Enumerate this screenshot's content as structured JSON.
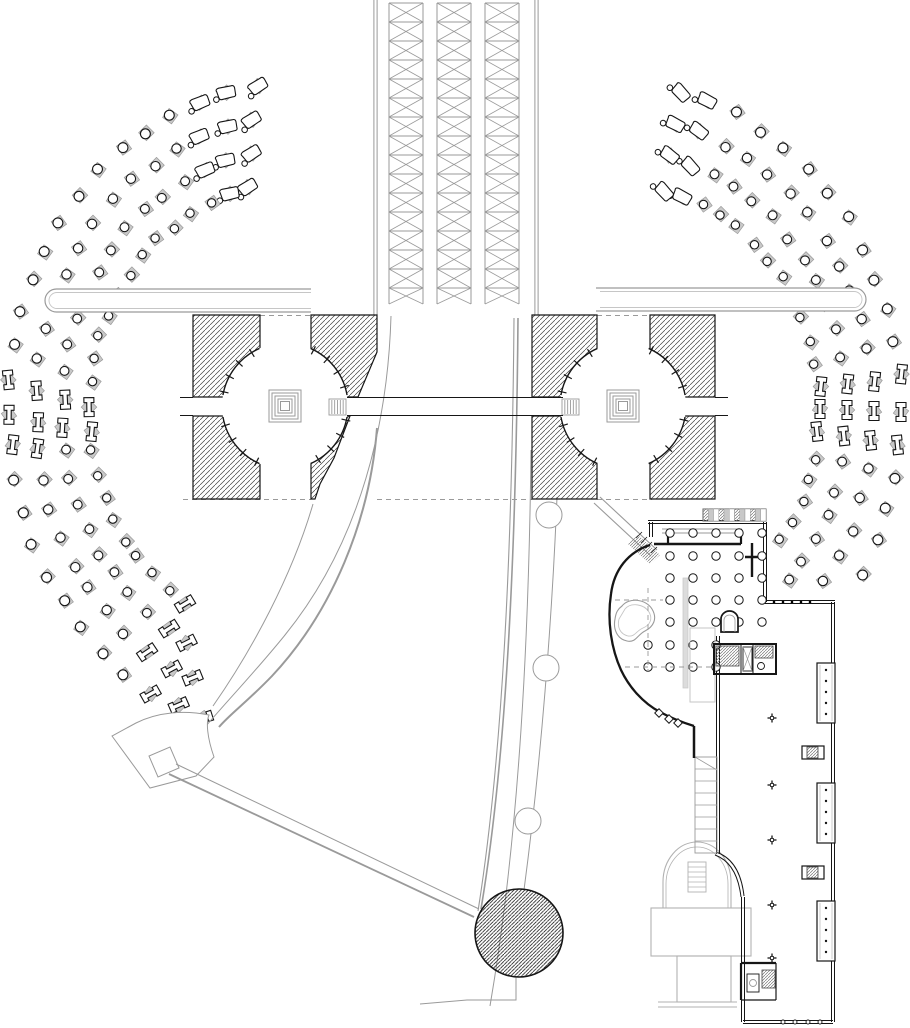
{
  "meta": {
    "title": "architectural-site-plan",
    "canvas_w": 910,
    "canvas_h": 1028,
    "background": "#ffffff"
  },
  "palette": {
    "k": "#161616",
    "g": "#9a9a9a",
    "lg": "#c6c6c6",
    "mg": "#b2b2b2",
    "w": "#ffffff",
    "hatch_line": "#3c3c3c",
    "hatch_dense": "#1a1a1a",
    "hatch_gray": "#777777",
    "marker_fill": "#c9c9c9",
    "marker_edge": "#9a9a9a"
  },
  "truss": {
    "rails": [
      375.5,
      536.5
    ],
    "rail_off": 1.6,
    "y0": 0,
    "y1": 315,
    "columns": [
      [
        389,
        423
      ],
      [
        437,
        471
      ],
      [
        485,
        519
      ]
    ],
    "col_y0": 3,
    "col_y1": 304,
    "panel_h": 19
  },
  "bars": [
    {
      "x0": 45,
      "x1": 311,
      "y": 289,
      "h": 23,
      "cap": "left"
    },
    {
      "x0": 596,
      "x1": 866,
      "y": 288,
      "h": 23,
      "cap": "right"
    }
  ],
  "pavilions": [
    {
      "name": "west",
      "blocks": [
        [
          [
            193,
            315
          ],
          [
            260,
            315
          ],
          [
            260,
            397
          ],
          [
            193,
            397
          ]
        ],
        [
          [
            193,
            416
          ],
          [
            260,
            416
          ],
          [
            260,
            499
          ],
          [
            193,
            499
          ]
        ],
        [
          [
            311,
            315
          ],
          [
            377,
            315
          ],
          [
            377,
            352
          ],
          [
            358,
            397
          ],
          [
            311,
            397
          ]
        ],
        [
          [
            311,
            416
          ],
          [
            350,
            416
          ],
          [
            334,
            458
          ],
          [
            320,
            484
          ],
          [
            315,
            499
          ],
          [
            311,
            499
          ]
        ]
      ],
      "circle": {
        "cx": 285,
        "cy": 406,
        "r": 63
      },
      "squares": [
        32,
        26,
        20,
        14,
        9
      ],
      "arc_segments": [
        [
          10,
          66
        ],
        [
          114,
          170
        ],
        [
          190,
          246
        ],
        [
          294,
          350
        ]
      ],
      "stair_box": {
        "x": 329,
        "y": 399,
        "w": 17,
        "h": 16,
        "n": 6
      }
    },
    {
      "name": "east",
      "blocks": [
        [
          [
            532,
            315
          ],
          [
            597,
            315
          ],
          [
            597,
            397
          ],
          [
            532,
            397
          ]
        ],
        [
          [
            532,
            416
          ],
          [
            597,
            416
          ],
          [
            597,
            499
          ],
          [
            532,
            499
          ]
        ],
        [
          [
            650,
            315
          ],
          [
            715,
            315
          ],
          [
            715,
            397
          ],
          [
            650,
            397
          ]
        ],
        [
          [
            650,
            416
          ],
          [
            715,
            416
          ],
          [
            715,
            499
          ],
          [
            650,
            499
          ]
        ]
      ],
      "circle": {
        "cx": 623,
        "cy": 406,
        "r": 63
      },
      "squares": [
        32,
        26,
        20,
        14,
        9
      ],
      "arc_segments": [
        [
          10,
          66
        ],
        [
          114,
          170
        ],
        [
          190,
          246
        ],
        [
          294,
          350
        ]
      ],
      "stair_box": {
        "x": 562,
        "y": 399,
        "w": 17,
        "h": 16,
        "n": 6
      }
    }
  ],
  "bands": [
    {
      "name": "west",
      "cx": 288,
      "cy": 410,
      "rx0": 198,
      "drx": 27,
      "ry0": 225,
      "dry": 33,
      "step": 6,
      "t0": [
        101,
        99.5,
        98,
        96.5
      ],
      "t1": [
        244,
        248,
        252,
        256
      ],
      "lounge": [
        90,
        112
      ],
      "ibeam": [
        174,
        189
      ],
      "tilt": [
        236,
        270
      ],
      "rot_base": 180,
      "lounge_rot": -30,
      "clips": []
    },
    {
      "name": "east",
      "cx": 622,
      "cy": 410,
      "rx0": 198,
      "drx": 27,
      "ry0": 225,
      "dry": 33,
      "step": 6,
      "t0": [
        -36,
        -42,
        -48,
        -54
      ],
      "t1": [
        78,
        79.5,
        81,
        82.5
      ],
      "lounge": [
        68,
        90
      ],
      "ibeam": [
        -8,
        8
      ],
      "tilt": [
        999,
        999
      ],
      "rot_base": 0,
      "lounge_rot": 30,
      "clips": [
        [
          648,
          508,
          120,
          97
        ],
        [
          768,
          598,
          142,
          430
        ]
      ]
    }
  ],
  "corridor": {
    "y_top": 397.5,
    "y_bot": 415.5,
    "segments": [
      [
        180,
        193
      ],
      [
        347,
        563
      ],
      [
        715,
        728
      ]
    ]
  },
  "promenade": [
    {
      "t": "path",
      "d": "M391,316 C388,420 362,540 285,635 C255,672 228,700 206,726",
      "c": "g",
      "w": 1
    },
    {
      "t": "path",
      "d": "M377,428 C370,520 332,612 272,676 C247,702 230,714 219,727",
      "c": "g",
      "w": 2
    },
    {
      "t": "path",
      "d": "M313,504 C292,576 252,650 213,706",
      "c": "g",
      "w": 1
    },
    {
      "t": "path",
      "d": "M514,318 C512,560 502,760 478,911",
      "c": "g",
      "w": 1.1
    },
    {
      "t": "path",
      "d": "M518,318 C516,560 506,760 481,909",
      "c": "g",
      "w": 1.6
    },
    {
      "t": "path",
      "d": "M531,450 C529,630 520,830 490,1006",
      "c": "g",
      "w": 1
    },
    {
      "t": "path",
      "d": "M557,497 C552,620 541,762 524,890",
      "c": "g",
      "w": 1
    },
    {
      "t": "path",
      "d": "M420,1004 L467,1000 L516,1000 L516,977",
      "c": "g",
      "w": 1
    },
    {
      "t": "dash",
      "x1": 183,
      "y1": 499.5,
      "x2": 311,
      "y2": 499.5
    },
    {
      "t": "dash",
      "x1": 377,
      "y1": 499.5,
      "x2": 532,
      "y2": 499.5
    },
    {
      "t": "dash",
      "x1": 597,
      "y1": 499.5,
      "x2": 652,
      "y2": 499.5
    },
    {
      "t": "dash",
      "x1": 260,
      "y1": 315.5,
      "x2": 311,
      "y2": 315.5
    },
    {
      "t": "dash",
      "x1": 597,
      "y1": 315.5,
      "x2": 650,
      "y2": 315.5
    }
  ],
  "wedge": [
    {
      "t": "path",
      "d": "M112,736 L150,788 L196,776 L214,757 C207,737 206,722 209,715 C184,710 158,712 136,723 Z",
      "c": "g",
      "w": 1,
      "f": "w"
    },
    {
      "t": "poly",
      "pts": [
        [
          179,
          768
        ],
        [
          170,
          747
        ],
        [
          149,
          756
        ],
        [
          158,
          777
        ]
      ],
      "c": "g",
      "w": 1,
      "f": "w"
    }
  ],
  "ramp_sw": [
    {
      "t": "line",
      "x1": 176,
      "y1": 764,
      "x2": 479,
      "y2": 909,
      "c": "g",
      "w": 1
    },
    {
      "t": "line",
      "x1": 169,
      "y1": 774,
      "x2": 474,
      "y2": 917,
      "c": "g",
      "w": 1.8
    }
  ],
  "ramp_ne": [
    {
      "t": "line",
      "x1": 594,
      "y1": 503,
      "x2": 651,
      "y2": 556,
      "c": "g",
      "w": 1.1
    },
    {
      "t": "line",
      "x1": 600,
      "y1": 497,
      "x2": 657,
      "y2": 550,
      "c": "g",
      "w": 1.1
    },
    {
      "t": "poly",
      "pts": [
        [
          638,
          535
        ],
        [
          660,
          555
        ],
        [
          650,
          564
        ],
        [
          628,
          544
        ]
      ],
      "f": "hg"
    },
    {
      "t": "line",
      "x1": 636,
      "y1": 538,
      "x2": 642,
      "y2": 532,
      "c": "k",
      "w": 0.8
    },
    {
      "t": "line",
      "x1": 641,
      "y1": 543,
      "x2": 647,
      "y2": 537,
      "c": "k",
      "w": 0.8
    },
    {
      "t": "line",
      "x1": 646,
      "y1": 548,
      "x2": 652,
      "y2": 542,
      "c": "k",
      "w": 0.8
    },
    {
      "t": "line",
      "x1": 651,
      "y1": 553,
      "x2": 657,
      "y2": 547,
      "c": "k",
      "w": 0.8
    }
  ],
  "path_circles": [
    [
      549,
      515,
      13
    ],
    [
      546,
      668,
      13
    ],
    [
      528,
      821,
      13
    ]
  ],
  "plaza_circle": {
    "cx": 519,
    "cy": 933,
    "r": 44
  },
  "chapel": [
    {
      "t": "path",
      "d": "M663,908 L663,882 A34 40 0 0 1 731,882 L731,908",
      "c": "mg",
      "w": 1.1
    },
    {
      "t": "path",
      "d": "M666,908 L666,884 A31 37 0 0 1 728,884 L728,908",
      "c": "mg",
      "w": 0.8
    },
    {
      "t": "rect",
      "x": 651,
      "y": 908,
      "w": 100,
      "h": 48,
      "c": "mg",
      "w2": 1.1
    },
    {
      "t": "rect",
      "x": 677,
      "y": 956,
      "w": 54,
      "h": 46,
      "c": "mg",
      "w2": 1.1
    },
    {
      "t": "line",
      "x1": 658,
      "y1": 1002,
      "x2": 737,
      "y2": 1002,
      "c": "mg",
      "w": 1
    },
    {
      "t": "line",
      "x1": 658,
      "y1": 1007,
      "x2": 737,
      "y2": 1007,
      "c": "mg",
      "w": 1
    },
    {
      "t": "stairs",
      "x": 688,
      "y": 862,
      "w": 18,
      "h": 30,
      "n": 6,
      "c": "mg"
    }
  ],
  "building": [
    {
      "t": "dline",
      "x1": 648,
      "y1": 522,
      "x2": 766,
      "y2": 522
    },
    {
      "t": "dline",
      "x1": 651,
      "y1": 522,
      "x2": 651,
      "y2": 537
    },
    {
      "t": "dline",
      "x1": 765,
      "y1": 522,
      "x2": 765,
      "y2": 602
    },
    {
      "t": "dline",
      "x1": 765,
      "y1": 602,
      "x2": 835,
      "y2": 602
    },
    {
      "t": "dots",
      "pts": [
        [
          774,
          602
        ],
        [
          783,
          602
        ],
        [
          792,
          602
        ],
        [
          801,
          602
        ],
        [
          810,
          602
        ]
      ],
      "r": 1.3,
      "f": "k"
    },
    {
      "t": "dline",
      "x1": 833,
      "y1": 602,
      "x2": 833,
      "y2": 1022
    },
    {
      "t": "dline",
      "x1": 833,
      "y1": 1022,
      "x2": 743,
      "y2": 1022
    },
    {
      "t": "dots",
      "pts": [
        [
          783,
          1022
        ],
        [
          795,
          1022
        ],
        [
          808,
          1022
        ],
        [
          820,
          1022
        ]
      ],
      "r": 2,
      "f": "w",
      "s": "k"
    },
    {
      "t": "dline",
      "x1": 743,
      "y1": 1022,
      "x2": 743,
      "y2": 897
    },
    {
      "t": "path",
      "d": "M744,896 Q740,860 716,852",
      "c": "k",
      "w": 1
    },
    {
      "t": "path",
      "d": "M741,897 Q737,863 715,855",
      "c": "k",
      "w": 1
    },
    {
      "t": "dline",
      "x1": 718,
      "y1": 636,
      "x2": 718,
      "y2": 854
    },
    {
      "t": "stairs",
      "x": 695,
      "y": 757,
      "w": 22,
      "h": 96,
      "n": 8,
      "c": "g"
    },
    {
      "t": "line",
      "x1": 695,
      "y1": 757,
      "x2": 717,
      "y2": 770,
      "c": "g",
      "w": 0.8
    },
    {
      "t": "line",
      "x1": 694,
      "y1": 726,
      "x2": 694,
      "y2": 758,
      "c": "k",
      "w": 2.5
    },
    {
      "t": "path",
      "d": "M650,545 C628,552 614,570 611,594 C607,620 611,648 621,670 C629,687 643,703 660,712 C671,718 681,722 694,726",
      "c": "k",
      "w": 2.3
    },
    {
      "t": "sq45",
      "x": 659,
      "y": 713,
      "s": 6
    },
    {
      "t": "sq45",
      "x": 669,
      "y": 719,
      "s": 6
    },
    {
      "t": "sq45",
      "x": 678,
      "y": 723,
      "s": 6
    },
    {
      "t": "line",
      "x1": 654,
      "y1": 544,
      "x2": 741,
      "y2": 544,
      "c": "k",
      "w": 2.6
    },
    {
      "t": "line",
      "x1": 668,
      "y1": 531,
      "x2": 668,
      "y2": 544,
      "c": "k",
      "w": 2.2
    },
    {
      "t": "line",
      "x1": 741,
      "y1": 531,
      "x2": 741,
      "y2": 544,
      "c": "k",
      "w": 2.2
    },
    {
      "t": "line",
      "x1": 662,
      "y1": 529,
      "x2": 742,
      "y2": 529,
      "c": "g",
      "w": 0.9
    },
    {
      "t": "line",
      "x1": 662,
      "y1": 533,
      "x2": 742,
      "y2": 533,
      "c": "g",
      "w": 0.9
    },
    {
      "t": "line",
      "x1": 752,
      "y1": 543,
      "x2": 752,
      "y2": 577,
      "c": "k",
      "w": 2.4
    },
    {
      "t": "line",
      "x1": 745,
      "y1": 557,
      "x2": 765,
      "y2": 557,
      "c": "k",
      "w": 2.4
    },
    {
      "t": "cells",
      "x": 703,
      "y": 509,
      "w": 63,
      "h": 12,
      "n": 12
    },
    {
      "t": "grid",
      "cols": [
        670,
        693,
        716,
        739,
        762
      ],
      "rows": [
        533,
        556,
        578,
        600,
        622
      ],
      "r": 4.2
    },
    {
      "t": "grid",
      "cols": [
        648,
        670,
        693,
        716
      ],
      "rows": [
        645,
        667
      ],
      "r": 4.2
    },
    {
      "t": "path",
      "d": "M622,606 C629,597 646,599 652,609 C658,619 653,627 645,631 C637,635 636,643 627,641 C617,639 613,629 615,619 C616,612 618,609 622,606 Z",
      "c": "g",
      "w": 1.1
    },
    {
      "t": "path",
      "d": "M625,609 C631,602 644,604 649,612 C653,619 650,625 643,628 C636,631 635,637 628,636 C620,634 617,627 619,619 Z",
      "c": "lg",
      "w": 0.9
    },
    {
      "t": "path",
      "d": "M721,632 L721,619 A8.5 8 0 0 1 738,619 L738,632 Z",
      "c": "k",
      "w": 1.7,
      "f": "w"
    },
    {
      "t": "path",
      "d": "M724,632 L724,620 A5.5 5 0 0 1 735,620 L735,632",
      "c": "g",
      "w": 0.8
    },
    {
      "t": "rect",
      "x": 690,
      "y": 628,
      "w": 25,
      "h": 74,
      "c": "lg",
      "w2": 1
    },
    {
      "t": "rect",
      "x": 683,
      "y": 578,
      "w": 5,
      "h": 110,
      "c": "lg",
      "w2": 0.7,
      "f": "#dcdcdc"
    },
    {
      "t": "dash",
      "x1": 648,
      "y1": 588,
      "x2": 648,
      "y2": 670
    },
    {
      "t": "dash",
      "x1": 625,
      "y1": 667,
      "x2": 712,
      "y2": 667
    },
    {
      "t": "dash",
      "x1": 615,
      "y1": 600,
      "x2": 663,
      "y2": 600
    },
    {
      "t": "rect",
      "x": 714,
      "y": 644,
      "w": 62,
      "h": 30,
      "c": "k",
      "w2": 2
    },
    {
      "t": "line",
      "x1": 741,
      "y1": 645,
      "x2": 741,
      "y2": 673,
      "c": "k",
      "w": 1
    },
    {
      "t": "line",
      "x1": 753,
      "y1": 645,
      "x2": 753,
      "y2": 673,
      "c": "k",
      "w": 1
    },
    {
      "t": "hatchrect",
      "x": 716,
      "y": 646,
      "w": 23,
      "h": 20
    },
    {
      "t": "rect",
      "x": 743,
      "y": 647,
      "w": 9,
      "h": 24,
      "c": "k",
      "w2": 0.9
    },
    {
      "t": "line",
      "x1": 743,
      "y1": 647,
      "x2": 752,
      "y2": 671,
      "c": "g",
      "w": 0.7
    },
    {
      "t": "line",
      "x1": 752,
      "y1": 647,
      "x2": 743,
      "y2": 671,
      "c": "g",
      "w": 0.7
    },
    {
      "t": "hatchrect",
      "x": 755,
      "y": 646,
      "w": 18,
      "h": 12
    },
    {
      "t": "circle",
      "cx": 761,
      "cy": 666,
      "r": 3.5,
      "c": "k",
      "w": 0.9,
      "f": "w"
    },
    {
      "t": "plus",
      "x": 772,
      "y": 718,
      "s": 9
    },
    {
      "t": "plus",
      "x": 772,
      "y": 785,
      "s": 9
    },
    {
      "t": "plus",
      "x": 772,
      "y": 840,
      "s": 9
    },
    {
      "t": "plus",
      "x": 772,
      "y": 905,
      "s": 9
    },
    {
      "t": "plus",
      "x": 772,
      "y": 958,
      "s": 9
    },
    {
      "t": "rect",
      "x": 802,
      "y": 746,
      "w": 22,
      "h": 13,
      "c": "k",
      "w2": 1.2,
      "f": "w"
    },
    {
      "t": "hatchrect",
      "x": 807,
      "y": 747,
      "w": 11,
      "h": 11
    },
    {
      "t": "rect",
      "x": 802,
      "y": 866,
      "w": 22,
      "h": 13,
      "c": "k",
      "w2": 1.2,
      "f": "w"
    },
    {
      "t": "hatchrect",
      "x": 807,
      "y": 867,
      "w": 11,
      "h": 11
    },
    {
      "t": "bay",
      "x": 817,
      "y": 663,
      "w": 18,
      "h": 60
    },
    {
      "t": "bay",
      "x": 817,
      "y": 783,
      "w": 18,
      "h": 60
    },
    {
      "t": "bay",
      "x": 817,
      "y": 901,
      "w": 18,
      "h": 60
    },
    {
      "t": "line",
      "x1": 741,
      "y1": 963,
      "x2": 776,
      "y2": 963,
      "c": "k",
      "w": 2.2
    },
    {
      "t": "line",
      "x1": 741,
      "y1": 963,
      "x2": 741,
      "y2": 1000,
      "c": "k",
      "w": 2.2
    },
    {
      "t": "line",
      "x1": 776,
      "y1": 963,
      "x2": 776,
      "y2": 1000,
      "c": "k",
      "w": 1.2
    },
    {
      "t": "line",
      "x1": 741,
      "y1": 1000,
      "x2": 776,
      "y2": 1000,
      "c": "k",
      "w": 1.2
    },
    {
      "t": "hatchrect",
      "x": 762,
      "y": 970,
      "w": 13,
      "h": 18
    },
    {
      "t": "rect",
      "x": 747,
      "y": 974,
      "w": 12,
      "h": 18,
      "c": "k",
      "w2": 0.9
    },
    {
      "t": "circle",
      "cx": 753,
      "cy": 983,
      "r": 3.5,
      "c": "g",
      "w": 0.9
    }
  ]
}
